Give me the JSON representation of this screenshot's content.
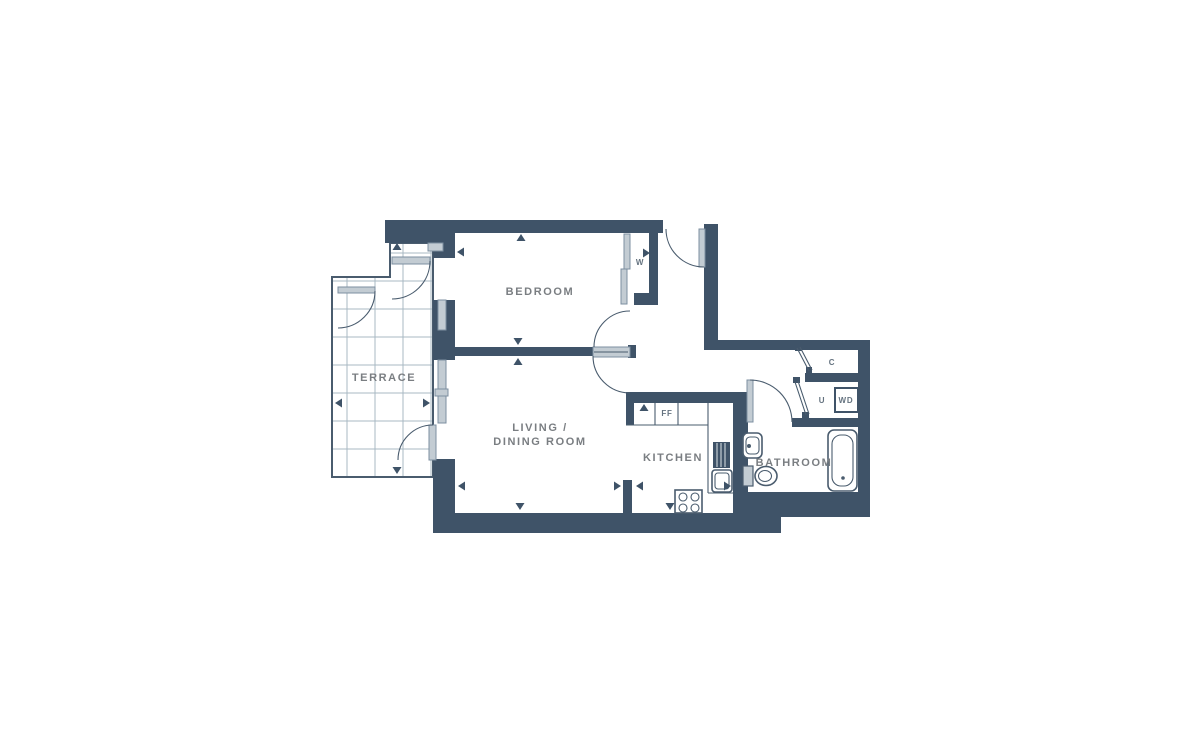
{
  "floorplan": {
    "rooms": {
      "terrace": "TERRACE",
      "bedroom": "BEDROOM",
      "living_line1": "LIVING /",
      "living_line2": "DINING ROOM",
      "kitchen": "KITCHEN",
      "bathroom": "BATHROOM"
    },
    "fixtures": {
      "wardrobe": "W",
      "fridge_freezer": "FF",
      "cupboard": "C",
      "utility": "U",
      "washer_dryer": "WD"
    },
    "colors": {
      "wall": "#3f5368",
      "line": "#4a5c6e",
      "leaf_gray": "#c3ccd3",
      "grid": "#a9b8c3",
      "room_label": "#7a7e82",
      "fixture_label": "#64727f",
      "background": "#ffffff"
    }
  }
}
